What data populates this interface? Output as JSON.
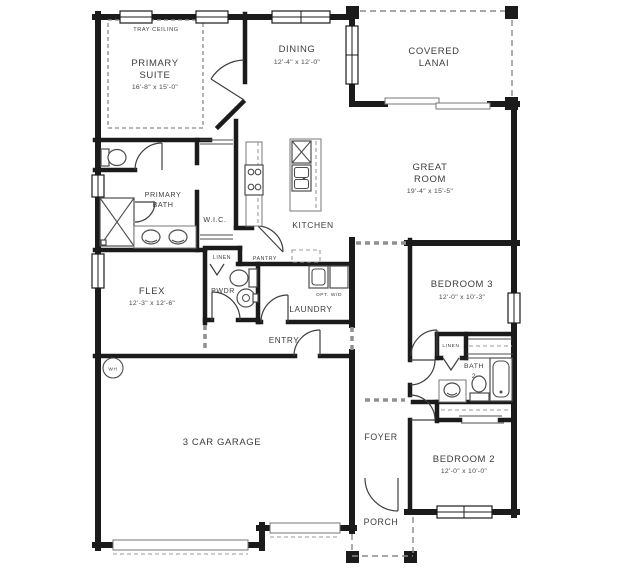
{
  "plan": {
    "rooms": {
      "primary_suite": {
        "ceiling_note": "TRAY CEILING",
        "name_line1": "PRIMARY",
        "name_line2": "SUITE",
        "dims": "16'-8\" x 15'-0\""
      },
      "dining": {
        "name": "DINING",
        "dims": "12'-4\" x 12'-0\""
      },
      "covered_lanai": {
        "name_line1": "COVERED",
        "name_line2": "LANAI"
      },
      "great_room": {
        "name_line1": "GREAT",
        "name_line2": "ROOM",
        "dims": "19'-4\" x 15'-5\""
      },
      "kitchen": {
        "name": "KITCHEN"
      },
      "pantry": {
        "name": "PANTRY"
      },
      "primary_bath": {
        "name_line1": "PRIMARY",
        "name_line2": "BATH"
      },
      "wic": {
        "name": "W.I.C."
      },
      "linen_hall": {
        "name": "LINEN"
      },
      "powder": {
        "name": "PWDR"
      },
      "laundry": {
        "name": "LAUNDRY",
        "note": "OPT. W/D"
      },
      "entry": {
        "name": "ENTRY"
      },
      "flex": {
        "name": "FLEX",
        "dims": "12'-3\" x 12'-6\""
      },
      "bedroom3": {
        "name": "BEDROOM 3",
        "dims": "12'-0\" x 10'-3\""
      },
      "linen_bed": {
        "name": "LINEN"
      },
      "bath2": {
        "name_line1": "BATH",
        "name_line2": "2"
      },
      "bedroom2": {
        "name": "BEDROOM 2",
        "dims": "12'-0\" x 10'-0\""
      },
      "garage": {
        "name": "3 CAR GARAGE"
      },
      "foyer": {
        "name": "FOYER"
      },
      "porch": {
        "name": "PORCH"
      },
      "water_heater": {
        "label": "WH"
      }
    },
    "colors": {
      "wall": "#1b1b1b",
      "label_text": "#3d3d3d",
      "fixture_line": "#4d4d4d",
      "light_line": "#8a8a8a",
      "background": "#ffffff"
    }
  }
}
